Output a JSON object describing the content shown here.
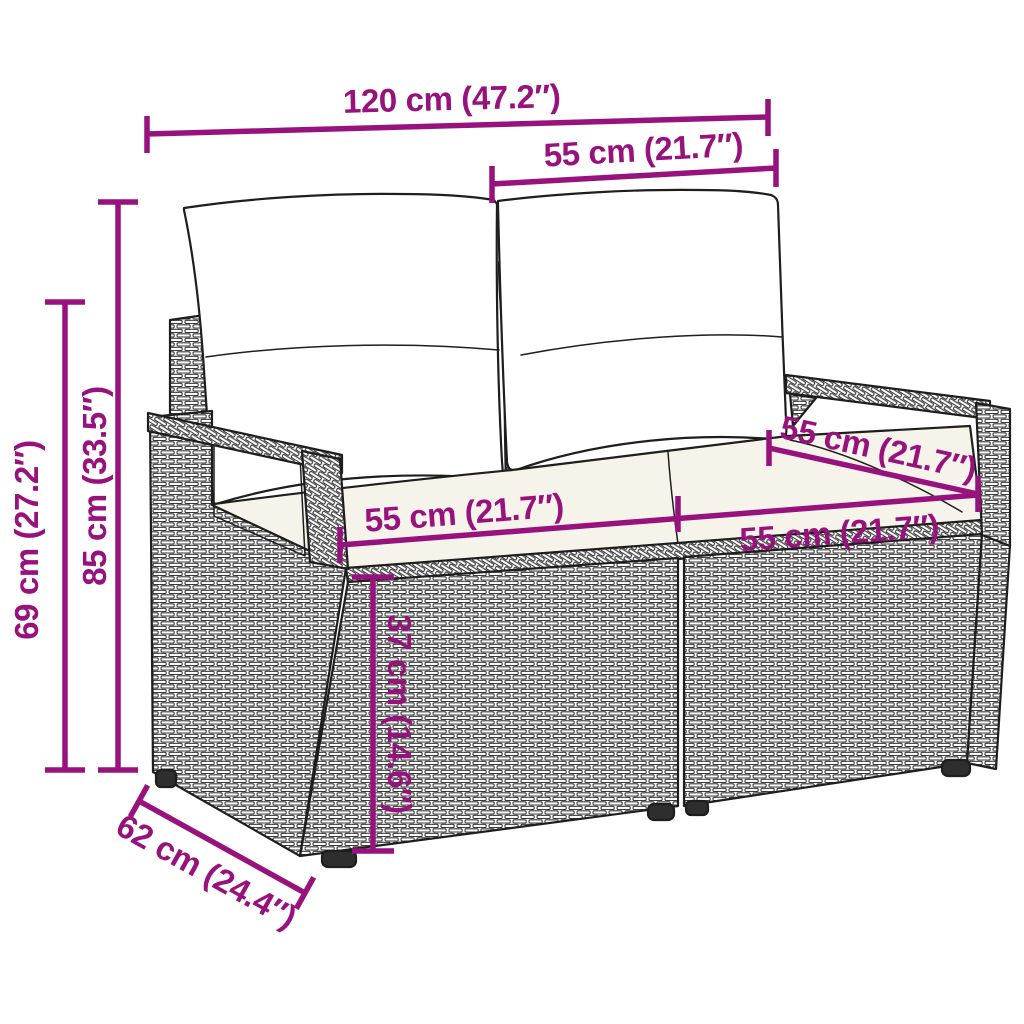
{
  "diagram": {
    "illustration": "two-seater poly rattan garden sofa with back and seat cushions",
    "style": "technical product dimension drawing"
  },
  "dims": {
    "overall_width": "120 cm (47.2″)",
    "seat_width_top": "55 cm (21.7″)",
    "back_height": "85 cm (33.5″)",
    "armrest_height": "69 cm (27.2″)",
    "seat_depth_right": "55 cm (21.7″)",
    "seat_width_left_section": "55 cm (21.7″)",
    "seat_width_right_section": "55 cm (21.7″)",
    "seat_height": "37 cm (14.6″)",
    "overall_depth": "62 cm (24.4″)"
  },
  "colors": {
    "dimension_accent": "#97127D",
    "line_art": "#1e1e1e",
    "background": "#ffffff",
    "back_cushion": "#ffffff",
    "seat_cushion": "#f6f3ea"
  }
}
